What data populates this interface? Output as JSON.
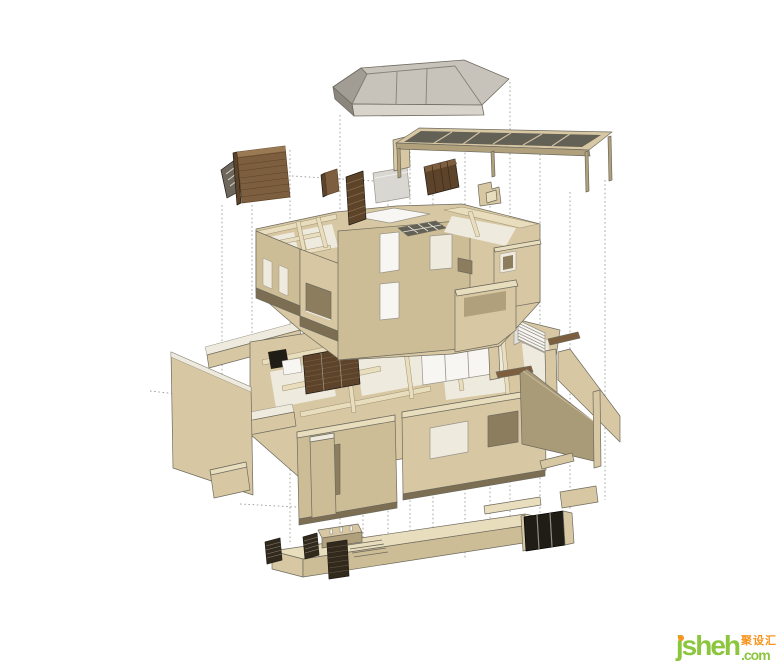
{
  "watermark": {
    "brand": "jsheh",
    "tld": ".com",
    "cjk": "聚设汇"
  },
  "colors": {
    "line": "#6e6a5e",
    "guide": "#9b9b93",
    "tanLight": "#e8ddbd",
    "tanMid": "#d7c8a3",
    "tanMid2": "#cdbd96",
    "tanDark": "#b0a07c",
    "oliveTan": "#a99a78",
    "shadow": "#8c7d5e",
    "shadow2": "#7c6e52",
    "floorPale": "#efeade",
    "white": "#f7f6f2",
    "roofLight": "#c7c3ba",
    "roofDark": "#a19d94",
    "roofDark2": "#8a867d",
    "roofFascia": "#d8d4cb",
    "glass": "#636055",
    "boardGray": "#d9d7d2",
    "grayLight": "#e3e1dc",
    "grayMid": "#6e675c",
    "grayLine": "#999489",
    "wood": "#7d5f3f",
    "woodLight": "#9a7a54",
    "woodDark": "#5c4329",
    "woodDark2": "#32291d",
    "dark": "#201c16",
    "green": "#8cc63f",
    "orange": "#f7941e"
  },
  "illustration": {
    "type": "exploded-axonometric-house-model",
    "components": [
      "hip-roof",
      "pergola-canopy",
      "loose-fittings",
      "upper-floor",
      "stair-assembly",
      "ground-floor",
      "base-level",
      "dotted-guides"
    ]
  }
}
